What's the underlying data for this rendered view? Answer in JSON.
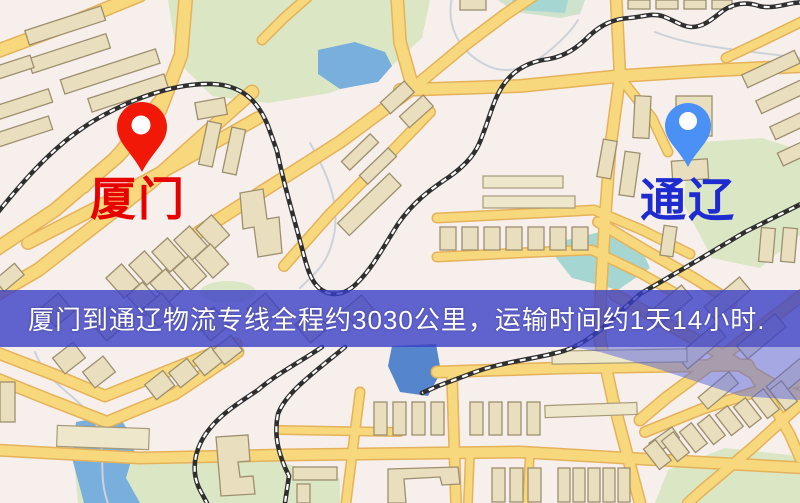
{
  "map": {
    "origin": {
      "label": "厦门",
      "pin_color": "#f21807",
      "label_color": "#e60000"
    },
    "destination": {
      "label": "通辽",
      "pin_color": "#4b90f5",
      "label_color": "#1e2bd0"
    }
  },
  "banner": {
    "text": "厦门到通辽物流专线全程约3030公里，运输时间约1天14小时.",
    "background_color": "rgba(58,62,198,0.8)",
    "text_color": "#ffffff"
  },
  "route_summary": {
    "origin": "厦门",
    "destination": "通辽",
    "distance": "约3030公里",
    "duration": "约1天14小时"
  },
  "map_style": {
    "background": "#f7efec",
    "road_fill": "#f8d87c",
    "road_casing": "#e5b25a",
    "building_fill": "#e9dfbf",
    "park_color": "#dbe6c4",
    "water_color": "#79afdc",
    "railway_color": "#2f2f2f"
  }
}
